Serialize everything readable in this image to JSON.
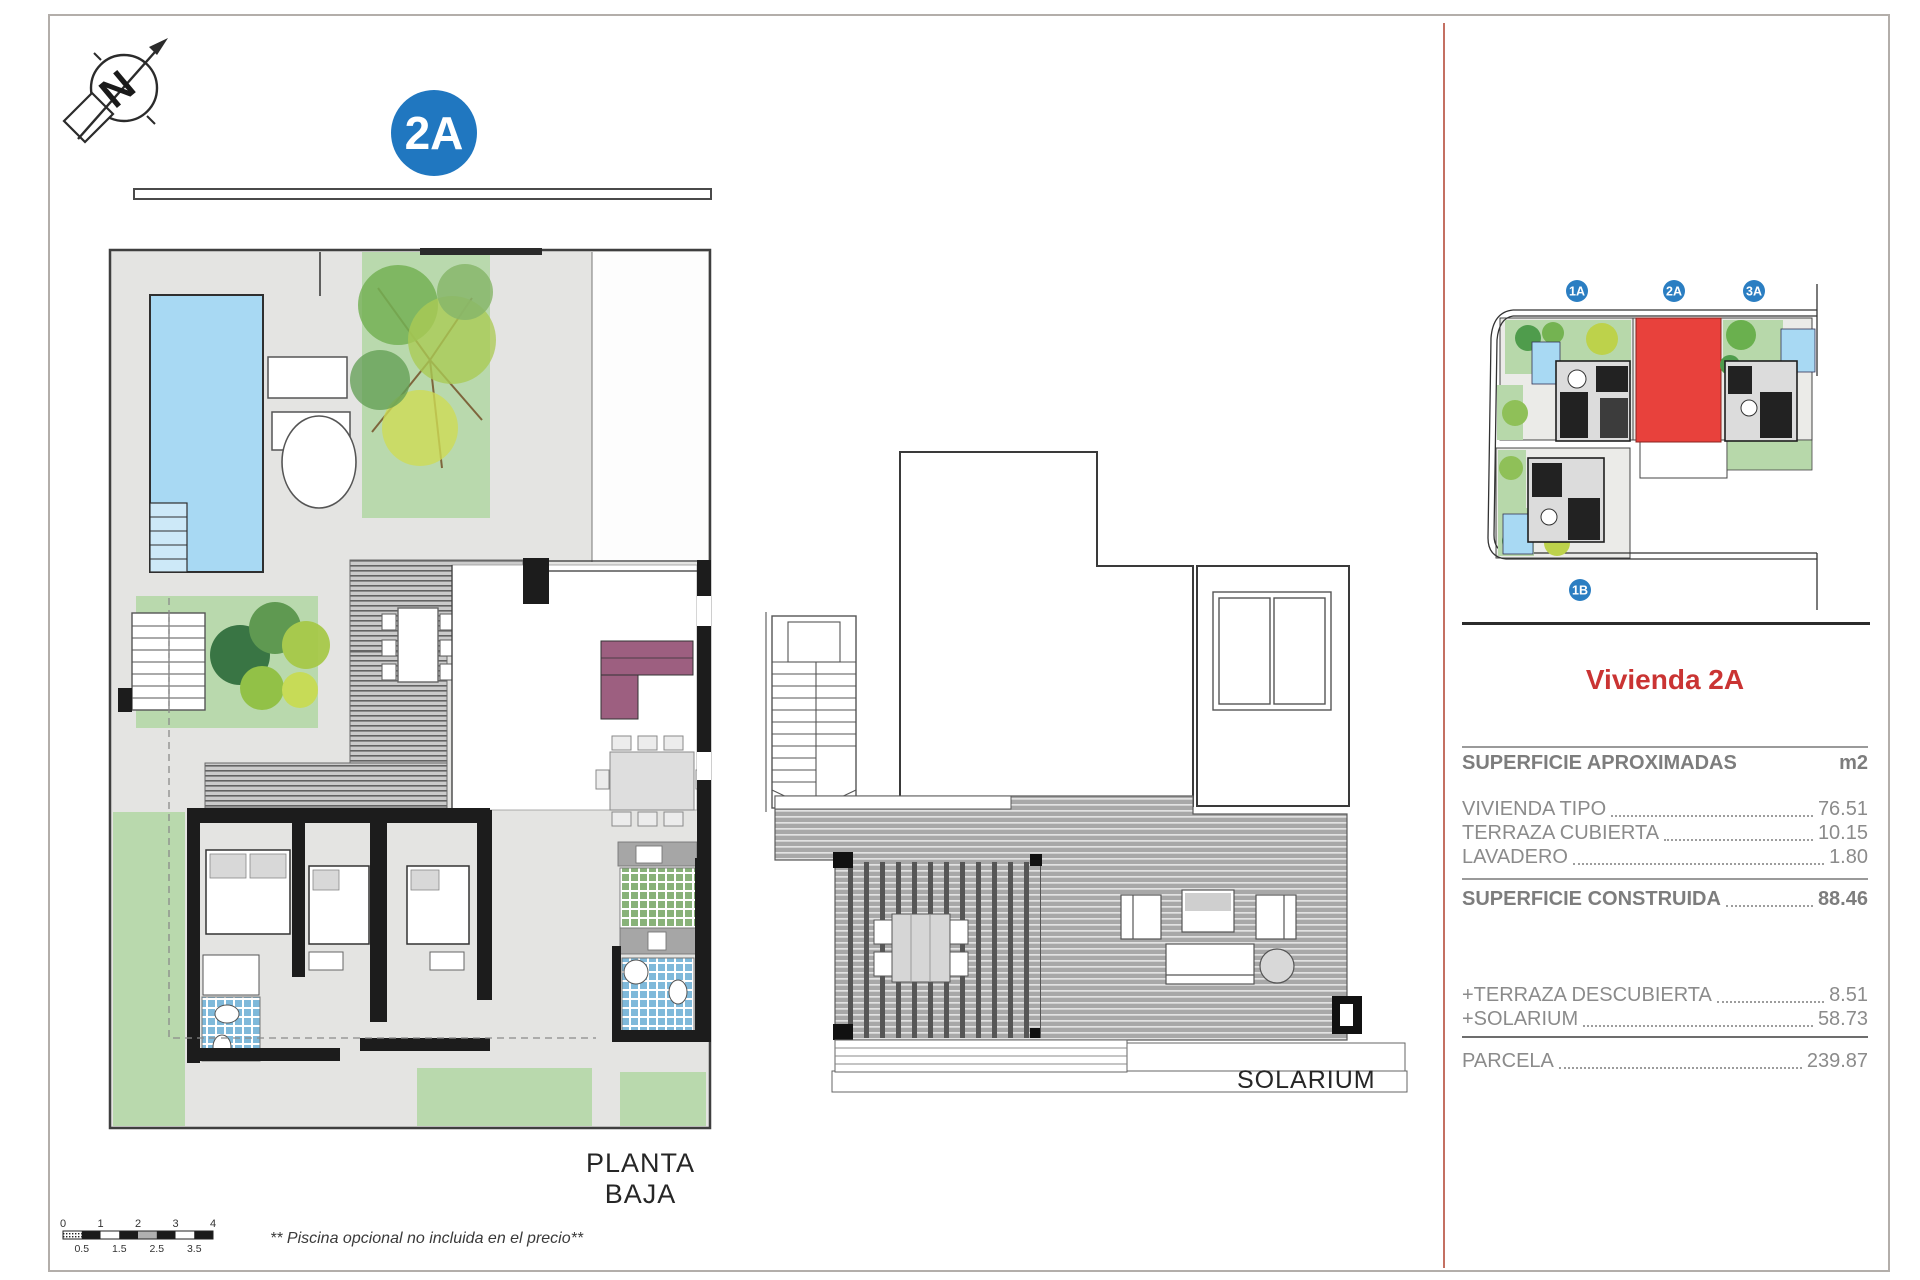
{
  "page": {
    "planta_label": "PLANTA BAJA",
    "solarium_label": "SOLARIUM",
    "footnote": "** Piscina opcional no incluida en el precio**"
  },
  "badge": {
    "main": "2A"
  },
  "compass": {
    "letter": "N"
  },
  "site_plan": {
    "badges": [
      {
        "id": "1A"
      },
      {
        "id": "2A"
      },
      {
        "id": "3A"
      },
      {
        "id": "1B"
      }
    ],
    "highlight_color": "#e8413c",
    "badge_color": "#2b7ec2"
  },
  "scale_bar": {
    "major": [
      "0",
      "1",
      "2",
      "3",
      "4"
    ],
    "minor": [
      "0.5",
      "1.5",
      "2.5",
      "3.5"
    ]
  },
  "panel": {
    "title": "Vivienda 2A",
    "title_color": "#ca3433",
    "header": {
      "label": "SUPERFICIE APROXIMADAS",
      "unit": "m2"
    },
    "rows": [
      {
        "label": "VIVIENDA TIPO",
        "value": "76.51"
      },
      {
        "label": "TERRAZA CUBIERTA",
        "value": "10.15"
      },
      {
        "label": "LAVADERO",
        "value": "1.80"
      }
    ],
    "construida": {
      "label": "SUPERFICIE CONSTRUIDA",
      "value": "88.46"
    },
    "extras": [
      {
        "label": "+TERRAZA DESCUBIERTA",
        "value": "8.51"
      },
      {
        "label": "+SOLARIUM",
        "value": "58.73"
      }
    ],
    "parcela": {
      "label": "PARCELA",
      "value": "239.87"
    }
  }
}
